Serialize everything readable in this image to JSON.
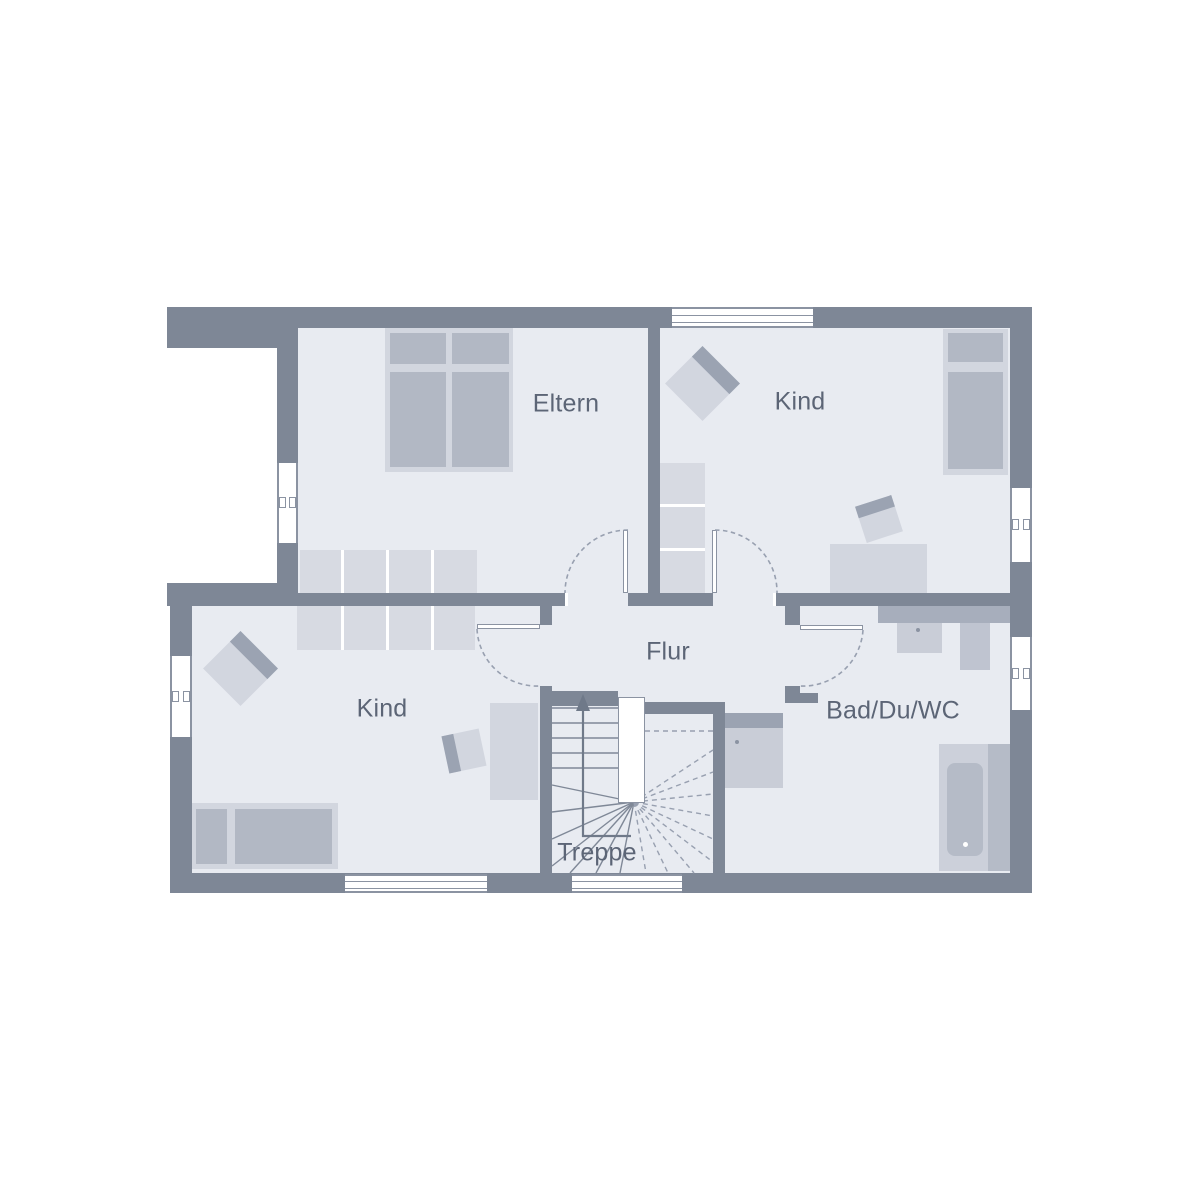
{
  "plan": {
    "type": "floor-plan",
    "rooms": {
      "eltern": {
        "label": "Eltern"
      },
      "kind_top": {
        "label": "Kind"
      },
      "kind_bottom": {
        "label": "Kind"
      },
      "flur": {
        "label": "Flur"
      },
      "treppe": {
        "label": "Treppe"
      },
      "bad": {
        "label": "Bad/Du/WC"
      }
    },
    "icons": {
      "stairs_direction": "up-arrow"
    }
  },
  "colors": {
    "background": "#ffffff",
    "wall": "#7e8796",
    "floor": "#e8ebf1",
    "furniture_light": "#d2d6df",
    "furniture_medium": "#b2b8c4",
    "wardrobe": "#d7dae2",
    "accent_band": "#9ba3b2",
    "counter": "#a7aebc",
    "fixture_mid": "#bfc4d0",
    "shower_body": "#c9cdd7",
    "tub_outer": "#ccd0da",
    "tub_inner": "#b5bbc7",
    "outline": "#8b93a2",
    "dashed": "#98a0b0",
    "stair_line": "#7f8897",
    "text": "#5c6576",
    "arrow": "#6f7989"
  }
}
